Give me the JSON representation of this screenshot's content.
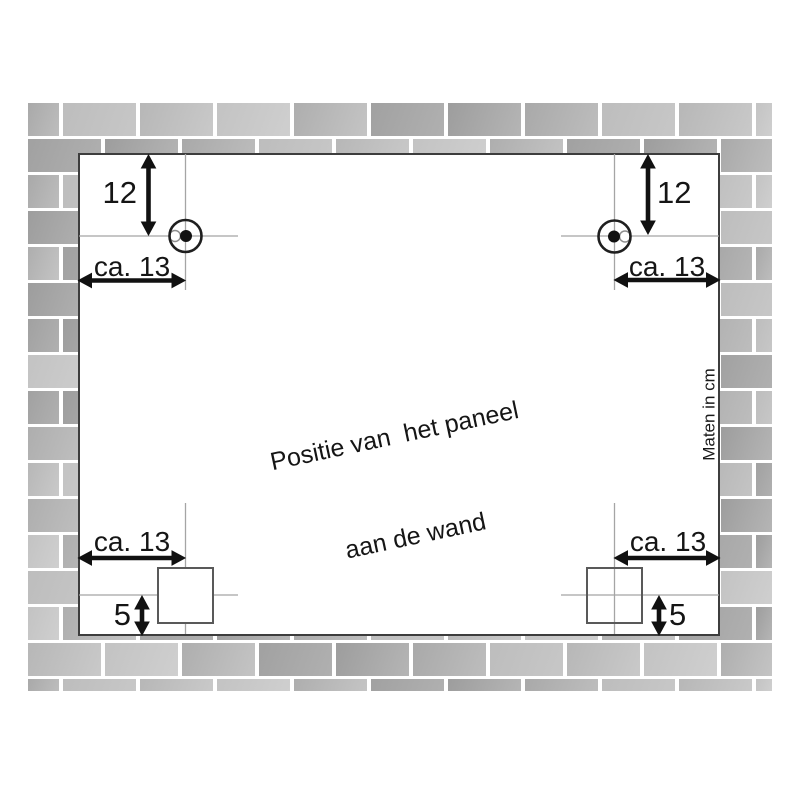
{
  "diagram": {
    "note_line1": "Positie van  het paneel",
    "note_line2": "aan de wand",
    "units_label": "Maten in cm"
  },
  "dims": {
    "top_left": {
      "vertical": "12",
      "horizontal": "ca. 13"
    },
    "top_right": {
      "vertical": "12",
      "horizontal": "ca. 13"
    },
    "bottom_left": {
      "vertical": "5",
      "horizontal": "ca. 13"
    },
    "bottom_right": {
      "vertical": "5",
      "horizontal": "ca. 13"
    }
  },
  "colors": {
    "ink": "#151515",
    "panel_border": "#3d3d3d",
    "square_border": "#595959",
    "crosshair": "#a5a5a5",
    "hole_stroke": "#1f1f1f",
    "notch_stroke": "#8f8f8f",
    "mortar": "#ffffff"
  },
  "wall": {
    "palette": [
      [
        "#a9a9a9",
        "#bdbdbd"
      ],
      [
        "#c3c3c3",
        "#cfcfcf"
      ],
      [
        "#9d9d9d",
        "#b5b5b5"
      ],
      [
        "#b7b7b7",
        "#c9c9c9"
      ],
      [
        "#a1a1a1",
        "#b0b0b0"
      ],
      [
        "#bdbdbd",
        "#c7c7c7"
      ],
      [
        "#aeaeae",
        "#c4c4c4"
      ]
    ]
  }
}
